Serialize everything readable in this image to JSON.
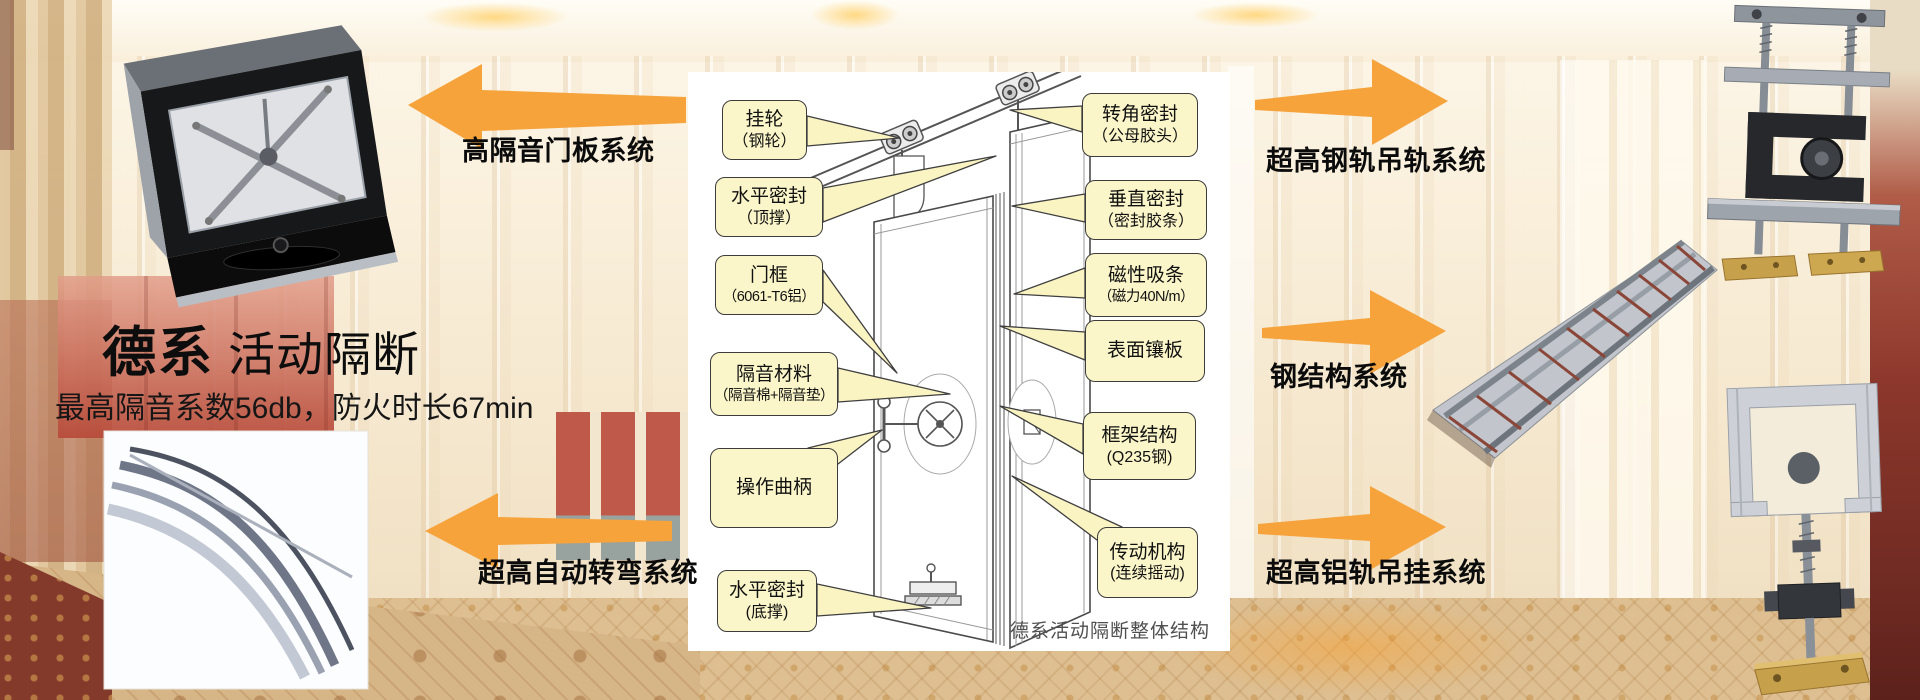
{
  "left": {
    "title_bold": "德系",
    "title_regular": "活动隔断",
    "subtitle": "最高隔音系数56db，防火时长67min"
  },
  "labels": {
    "top_left": "高隔音门板系统",
    "bottom_left": "超高自动转弯系统",
    "top_right": "超高钢轨吊轨系统",
    "mid_right": "钢结构系统",
    "bottom_right": "超高铝轨吊挂系统"
  },
  "diagram": {
    "caption": "德系活动隔断整体结构",
    "callouts_left": [
      {
        "line1": "挂轮",
        "line2": "（钢轮）"
      },
      {
        "line1": "水平密封",
        "line2": "（顶撑）"
      },
      {
        "line1": "门框",
        "line2": "（6061-T6铝）"
      },
      {
        "line1": "隔音材料",
        "line2": "（隔音棉+隔音垫）"
      },
      {
        "line1": "操作曲柄",
        "line2": ""
      },
      {
        "line1": "水平密封",
        "line2": "(底撑)"
      }
    ],
    "callouts_right": [
      {
        "line1": "转角密封",
        "line2": "（公母胶头）"
      },
      {
        "line1": "垂直密封",
        "line2": "（密封胶条）"
      },
      {
        "line1": "磁性吸条",
        "line2": "（磁力40N/m）"
      },
      {
        "line1": "表面镶板",
        "line2": ""
      },
      {
        "line1": "框架结构",
        "line2": "(Q235钢)"
      },
      {
        "line1": "传动机构",
        "line2": "(连续摇动)"
      }
    ]
  },
  "colors": {
    "arrow_orange": "#F6A33C",
    "callout_bg": "#FBF6C9",
    "callout_border": "#3C3C3C",
    "red_panel": "#BF5A4B",
    "carpet": "#DDBF92"
  }
}
